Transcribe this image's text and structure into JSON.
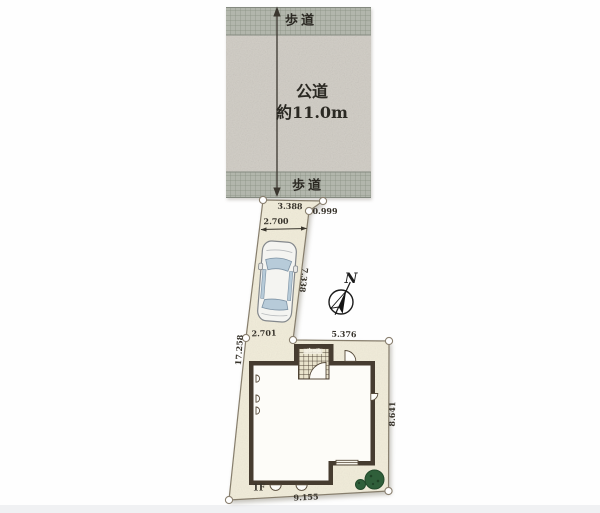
{
  "road": {
    "name": "公道",
    "width_label": "約11.0m",
    "top_sidewalk_label": "歩道",
    "bottom_sidewalk_label": "歩道"
  },
  "compass": {
    "north_label": "N"
  },
  "site": {
    "floor_label": "1F",
    "porch_label": "ポーチ"
  },
  "dimensions": {
    "top_edge": "3.388",
    "corner_cut": "0.999",
    "driveway_width": "2.700",
    "driveway_length": "7.338",
    "upper_west_edge": "2.701",
    "upper_east_edge": "5.376",
    "west_boundary": "17.258",
    "east_boundary": "8.641",
    "south_boundary": "9.155"
  },
  "colors": {
    "lot_fill": "#f1ecd9",
    "wall": "#463c30",
    "road_fill": "#cfcbc3",
    "sidewalk_fill": "#b2b6ac",
    "tree_green": "#2f5f3a",
    "car_window_blue": "#b7cbd9",
    "marker_fill": "#ffffff",
    "dimension_text": "#37332b"
  }
}
